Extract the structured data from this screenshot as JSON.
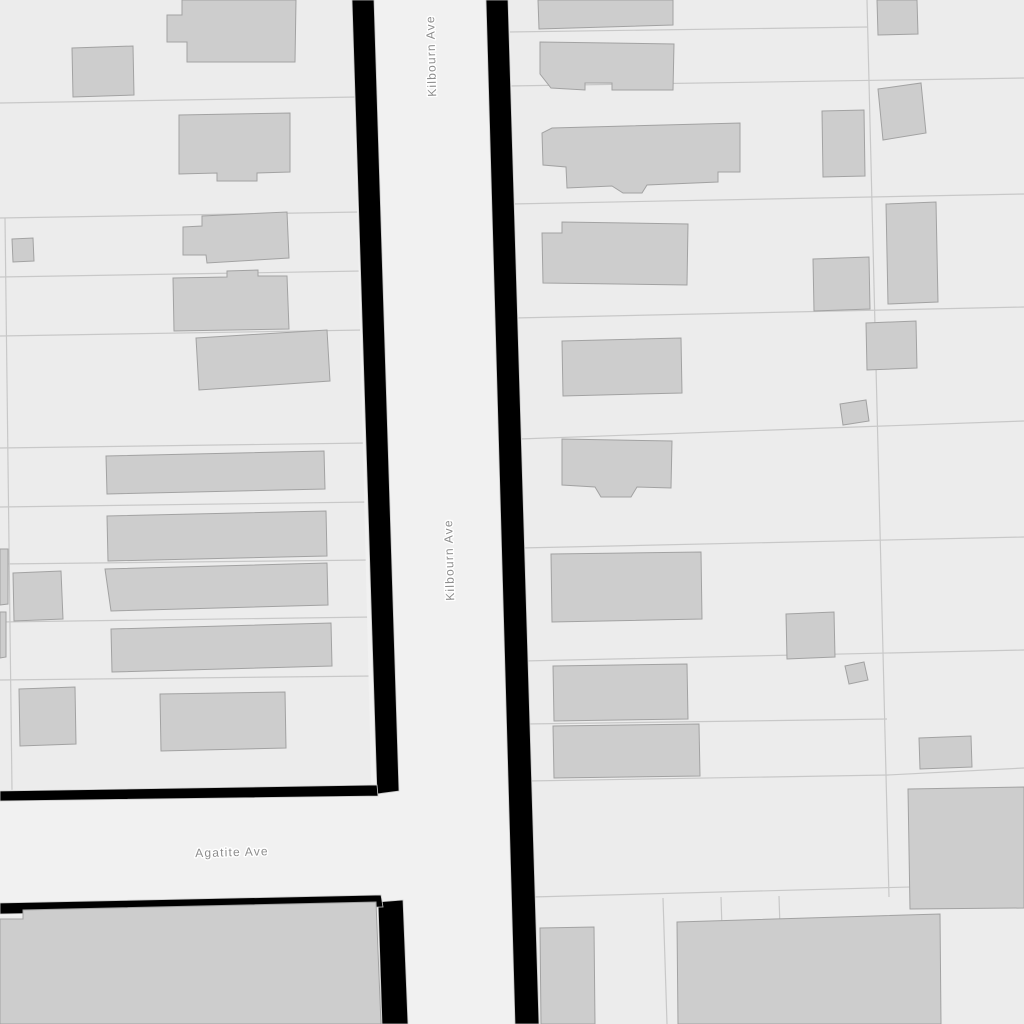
{
  "map": {
    "width": 1024,
    "height": 1024,
    "colors": {
      "parcel_background": "#ececec",
      "street_surface": "#f1f1f1",
      "street_casing": "#000000",
      "casing_edge": "#c9c9c9",
      "building_fill": "#cdcdcd",
      "building_stroke": "#a2a2a2",
      "parcel_line": "#c8c8c8",
      "label_text": "#8c8c8c",
      "label_halo": "#ffffff"
    },
    "streets": [
      {
        "id": "kilbourn-ave",
        "name": "Kilbourn Ave",
        "labels": [
          {
            "x": 432,
            "y": 56,
            "rotation": -91.5
          },
          {
            "x": 450,
            "y": 560,
            "rotation": -91.5
          }
        ]
      },
      {
        "id": "agatite-ave",
        "name": "Agatite Ave",
        "labels": [
          {
            "x": 232,
            "y": 853,
            "rotation": -1.5
          }
        ]
      }
    ],
    "street_surfaces": [
      {
        "street": "agatite-ave",
        "points": [
          [
            0,
            790
          ],
          [
            382,
            784
          ],
          [
            388,
            912
          ],
          [
            0,
            916
          ]
        ]
      },
      {
        "street": "kilbourn-ave",
        "points": [
          [
            352,
            0
          ],
          [
            509,
            0
          ],
          [
            539,
            1024
          ],
          [
            377,
            1024
          ]
        ]
      }
    ],
    "street_casings": [
      {
        "street": "kilbourn-ave",
        "side": "west-north",
        "points": [
          [
            352,
            0
          ],
          [
            374,
            0
          ],
          [
            399,
            791
          ],
          [
            377,
            794
          ]
        ]
      },
      {
        "street": "kilbourn-ave",
        "side": "west-south",
        "points": [
          [
            378,
            902
          ],
          [
            403,
            900
          ],
          [
            408,
            1024
          ],
          [
            382,
            1024
          ]
        ]
      },
      {
        "street": "kilbourn-ave",
        "side": "east",
        "points": [
          [
            486,
            0
          ],
          [
            508,
            0
          ],
          [
            539,
            1024
          ],
          [
            515,
            1024
          ]
        ]
      },
      {
        "street": "agatite-ave",
        "side": "north",
        "points": [
          [
            0,
            791
          ],
          [
            377,
            785
          ],
          [
            378,
            796
          ],
          [
            0,
            801
          ]
        ]
      },
      {
        "street": "agatite-ave",
        "side": "south",
        "points": [
          [
            0,
            903
          ],
          [
            381,
            895
          ],
          [
            383,
            907
          ],
          [
            0,
            914
          ]
        ]
      }
    ],
    "parcel_lines": [
      [
        0,
        103,
        357,
        97
      ],
      [
        0,
        218,
        360,
        212
      ],
      [
        0,
        277,
        362,
        271
      ],
      [
        0,
        336,
        364,
        330
      ],
      [
        0,
        448,
        367,
        443
      ],
      [
        0,
        507,
        369,
        502
      ],
      [
        0,
        564,
        371,
        560
      ],
      [
        0,
        622,
        373,
        617
      ],
      [
        0,
        680,
        374,
        676
      ],
      [
        5,
        218,
        12,
        790
      ],
      [
        506,
        32,
        868,
        27
      ],
      [
        507,
        86,
        1024,
        78
      ],
      [
        511,
        204,
        1024,
        194
      ],
      [
        514,
        318,
        1024,
        307
      ],
      [
        519,
        439,
        1024,
        421
      ],
      [
        520,
        548,
        1024,
        537
      ],
      [
        523,
        661,
        1024,
        650
      ],
      [
        525,
        724,
        887,
        719
      ],
      [
        527,
        781,
        888,
        775
      ],
      [
        888,
        775,
        1024,
        768
      ],
      [
        532,
        897,
        1024,
        884
      ],
      [
        867,
        0,
        889,
        897
      ],
      [
        663,
        898,
        667,
        1024
      ],
      [
        721,
        897,
        725,
        1024
      ],
      [
        779,
        896,
        783,
        1024
      ]
    ],
    "buildings": [
      {
        "points": [
          [
            182,
            0
          ],
          [
            296,
            0
          ],
          [
            295,
            62
          ],
          [
            187,
            62
          ],
          [
            187,
            42
          ],
          [
            167,
            42
          ],
          [
            167,
            15
          ],
          [
            182,
            15
          ]
        ]
      },
      {
        "points": [
          [
            72,
            48
          ],
          [
            133,
            46
          ],
          [
            134,
            95
          ],
          [
            73,
            97
          ]
        ]
      },
      {
        "points": [
          [
            179,
            115
          ],
          [
            290,
            113
          ],
          [
            290,
            172
          ],
          [
            257,
            173
          ],
          [
            257,
            181
          ],
          [
            217,
            181
          ],
          [
            217,
            173
          ],
          [
            179,
            174
          ]
        ]
      },
      {
        "points": [
          [
            12,
            239
          ],
          [
            33,
            238
          ],
          [
            34,
            261
          ],
          [
            13,
            262
          ]
        ]
      },
      {
        "points": [
          [
            183,
            227
          ],
          [
            202,
            226
          ],
          [
            202,
            216
          ],
          [
            287,
            212
          ],
          [
            289,
            258
          ],
          [
            207,
            263
          ],
          [
            206,
            255
          ],
          [
            183,
            255
          ]
        ]
      },
      {
        "points": [
          [
            173,
            278
          ],
          [
            227,
            277
          ],
          [
            227,
            271
          ],
          [
            258,
            270
          ],
          [
            258,
            276
          ],
          [
            287,
            276
          ],
          [
            289,
            329
          ],
          [
            174,
            331
          ]
        ]
      },
      {
        "points": [
          [
            196,
            338
          ],
          [
            327,
            330
          ],
          [
            330,
            381
          ],
          [
            199,
            390
          ]
        ]
      },
      {
        "points": [
          [
            106,
            456
          ],
          [
            324,
            451
          ],
          [
            325,
            489
          ],
          [
            107,
            494
          ]
        ]
      },
      {
        "points": [
          [
            107,
            516
          ],
          [
            326,
            511
          ],
          [
            327,
            556
          ],
          [
            108,
            561
          ]
        ]
      },
      {
        "points": [
          [
            105,
            569
          ],
          [
            327,
            563
          ],
          [
            328,
            605
          ],
          [
            111,
            611
          ]
        ]
      },
      {
        "points": [
          [
            13,
            573
          ],
          [
            61,
            571
          ],
          [
            63,
            619
          ],
          [
            14,
            621
          ]
        ]
      },
      {
        "points": [
          [
            0,
            549
          ],
          [
            8,
            549
          ],
          [
            8,
            604
          ],
          [
            0,
            605
          ]
        ]
      },
      {
        "points": [
          [
            0,
            612
          ],
          [
            6,
            612
          ],
          [
            6,
            657
          ],
          [
            0,
            658
          ]
        ]
      },
      {
        "points": [
          [
            111,
            629
          ],
          [
            331,
            623
          ],
          [
            332,
            666
          ],
          [
            112,
            672
          ]
        ]
      },
      {
        "points": [
          [
            19,
            689
          ],
          [
            75,
            687
          ],
          [
            76,
            744
          ],
          [
            20,
            746
          ]
        ]
      },
      {
        "points": [
          [
            160,
            694
          ],
          [
            285,
            692
          ],
          [
            286,
            748
          ],
          [
            161,
            751
          ]
        ]
      },
      {
        "points": [
          [
            0,
            919
          ],
          [
            23,
            919
          ],
          [
            23,
            910
          ],
          [
            376,
            902
          ],
          [
            381,
            1024
          ],
          [
            0,
            1024
          ]
        ]
      },
      {
        "points": [
          [
            538,
            0
          ],
          [
            673,
            0
          ],
          [
            673,
            25
          ],
          [
            539,
            29
          ]
        ]
      },
      {
        "points": [
          [
            540,
            42
          ],
          [
            674,
            44
          ],
          [
            673,
            90
          ],
          [
            612,
            90
          ],
          [
            612,
            83
          ],
          [
            585,
            83
          ],
          [
            585,
            90
          ],
          [
            551,
            88
          ],
          [
            540,
            74
          ]
        ]
      },
      {
        "points": [
          [
            552,
            128
          ],
          [
            740,
            123
          ],
          [
            740,
            172
          ],
          [
            718,
            172
          ],
          [
            718,
            182
          ],
          [
            647,
            185
          ],
          [
            642,
            193
          ],
          [
            623,
            193
          ],
          [
            612,
            186
          ],
          [
            567,
            188
          ],
          [
            566,
            167
          ],
          [
            543,
            165
          ],
          [
            542,
            133
          ]
        ]
      },
      {
        "points": [
          [
            542,
            233
          ],
          [
            562,
            233
          ],
          [
            562,
            222
          ],
          [
            688,
            224
          ],
          [
            687,
            285
          ],
          [
            543,
            283
          ]
        ]
      },
      {
        "points": [
          [
            813,
            259
          ],
          [
            869,
            257
          ],
          [
            870,
            309
          ],
          [
            814,
            311
          ]
        ]
      },
      {
        "points": [
          [
            886,
            204
          ],
          [
            936,
            202
          ],
          [
            938,
            302
          ],
          [
            888,
            304
          ]
        ]
      },
      {
        "points": [
          [
            878,
            89
          ],
          [
            921,
            83
          ],
          [
            926,
            133
          ],
          [
            883,
            140
          ]
        ]
      },
      {
        "points": [
          [
            877,
            0
          ],
          [
            917,
            0
          ],
          [
            918,
            34
          ],
          [
            878,
            35
          ]
        ]
      },
      {
        "points": [
          [
            822,
            111
          ],
          [
            864,
            110
          ],
          [
            865,
            176
          ],
          [
            823,
            177
          ]
        ]
      },
      {
        "points": [
          [
            562,
            341
          ],
          [
            681,
            338
          ],
          [
            682,
            393
          ],
          [
            563,
            396
          ]
        ]
      },
      {
        "points": [
          [
            840,
            404
          ],
          [
            866,
            400
          ],
          [
            869,
            421
          ],
          [
            843,
            425
          ]
        ]
      },
      {
        "points": [
          [
            866,
            323
          ],
          [
            916,
            321
          ],
          [
            917,
            368
          ],
          [
            867,
            370
          ]
        ]
      },
      {
        "points": [
          [
            562,
            439
          ],
          [
            672,
            441
          ],
          [
            671,
            488
          ],
          [
            637,
            487
          ],
          [
            631,
            497
          ],
          [
            601,
            497
          ],
          [
            595,
            487
          ],
          [
            562,
            485
          ]
        ]
      },
      {
        "points": [
          [
            551,
            554
          ],
          [
            701,
            552
          ],
          [
            702,
            619
          ],
          [
            552,
            622
          ]
        ]
      },
      {
        "points": [
          [
            786,
            614
          ],
          [
            834,
            612
          ],
          [
            835,
            657
          ],
          [
            787,
            659
          ]
        ]
      },
      {
        "points": [
          [
            845,
            666
          ],
          [
            864,
            662
          ],
          [
            868,
            680
          ],
          [
            849,
            684
          ]
        ]
      },
      {
        "points": [
          [
            553,
            666
          ],
          [
            687,
            664
          ],
          [
            688,
            719
          ],
          [
            554,
            721
          ]
        ]
      },
      {
        "points": [
          [
            553,
            726
          ],
          [
            699,
            724
          ],
          [
            700,
            776
          ],
          [
            554,
            778
          ]
        ]
      },
      {
        "points": [
          [
            919,
            738
          ],
          [
            971,
            736
          ],
          [
            972,
            767
          ],
          [
            920,
            769
          ]
        ]
      },
      {
        "points": [
          [
            908,
            789
          ],
          [
            1024,
            787
          ],
          [
            1024,
            908
          ],
          [
            910,
            909
          ]
        ]
      },
      {
        "points": [
          [
            540,
            928
          ],
          [
            594,
            927
          ],
          [
            595,
            1024
          ],
          [
            541,
            1024
          ]
        ]
      },
      {
        "points": [
          [
            677,
            922
          ],
          [
            940,
            914
          ],
          [
            941,
            1024
          ],
          [
            678,
            1024
          ]
        ]
      }
    ]
  }
}
